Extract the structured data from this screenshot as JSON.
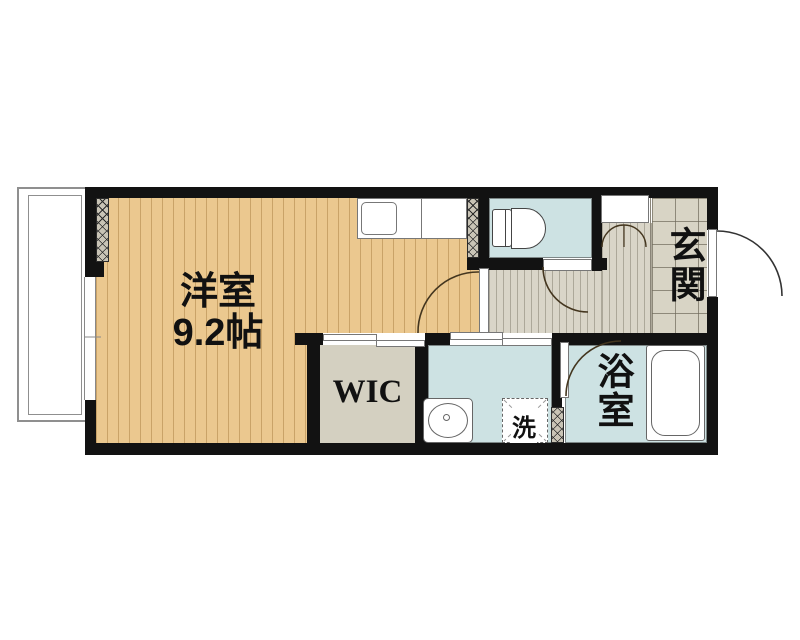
{
  "floorplan": {
    "rooms": {
      "main": {
        "name_ja": "洋室",
        "size_label": "9.2帖",
        "floor_color": "#ebc88f"
      },
      "wic": {
        "label": "WIC",
        "floor_color": "#d4d0c1"
      },
      "genkan": {
        "label": "玄関",
        "floor_color": "#d8d4c5"
      },
      "bathroom": {
        "label": "浴室",
        "floor_color": "#cde2e3"
      },
      "washroom": {
        "washer_label": "洗",
        "floor_color": "#cde2e3"
      },
      "toilet": {
        "floor_color": "#cde2e3"
      },
      "hallway": {
        "floor_color": "#d9d5c8"
      },
      "balcony": {
        "floor_color": "#ffffff"
      }
    },
    "fixtures": [
      "kitchen-counter-sink",
      "toilet",
      "shoe-cabinet",
      "closet-double-door",
      "entrance-door",
      "interior-swing-doors",
      "sliding-doors",
      "wash-basin",
      "washing-machine-space",
      "bathtub",
      "window",
      "balcony"
    ],
    "colors": {
      "wall": "#121212",
      "door_arc": "#44361f",
      "teal_room": "#cde2e3",
      "wood_floor": "#ebc88f",
      "hall_floor": "#d9d5c8",
      "genkan_tile": "#d8d4c5"
    }
  }
}
